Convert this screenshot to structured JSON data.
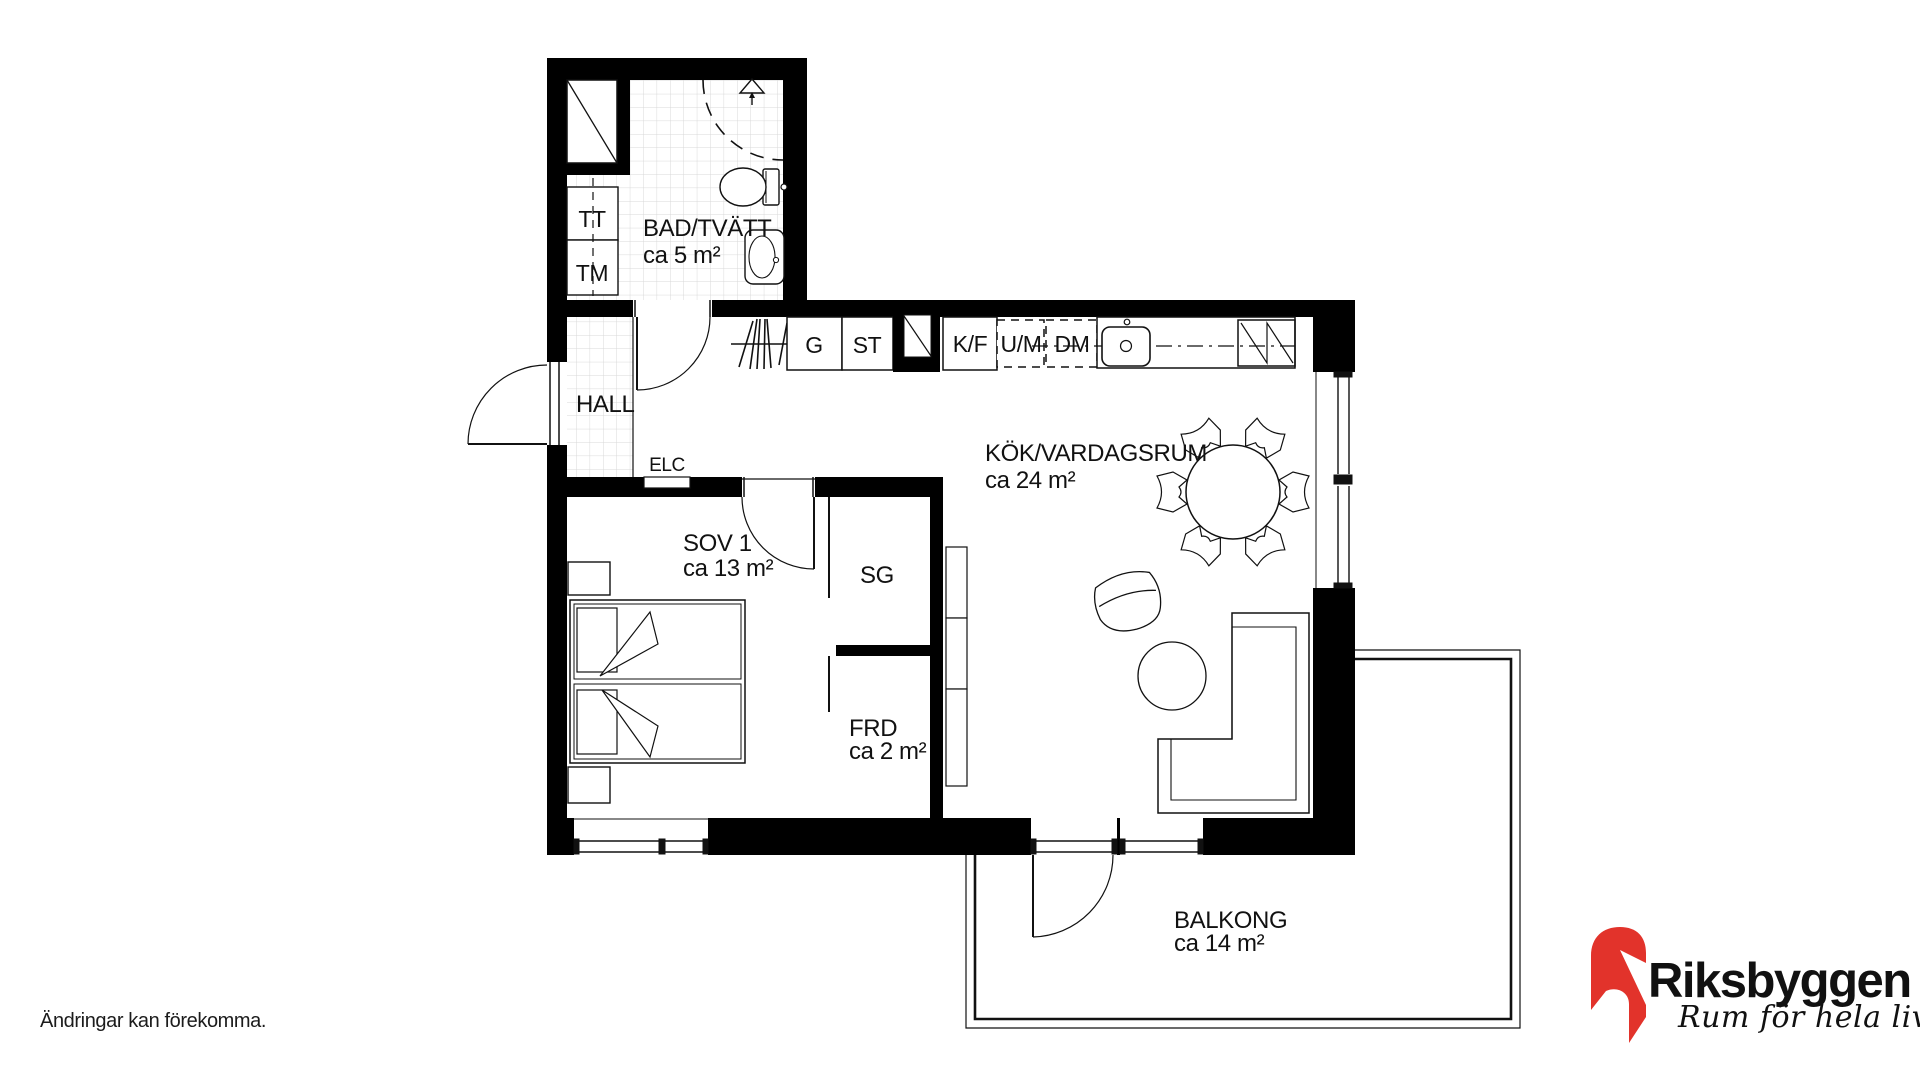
{
  "plan": {
    "rooms": {
      "bathroom": {
        "name": "BAD/TVÄTT",
        "area": "ca 5 m²"
      },
      "hall": {
        "name": "HALL"
      },
      "kitchen_living": {
        "name": "KÖK/VARDAGSRUM",
        "area": "ca 24 m²"
      },
      "bedroom": {
        "name": "SOV 1",
        "area": "ca 13 m²"
      },
      "sliding_wardrobe": {
        "name": "SG"
      },
      "storage": {
        "name": "FRD",
        "area": "ca 2 m²"
      },
      "balcony": {
        "name": "BALKONG",
        "area": "ca 14 m²"
      }
    },
    "fixtures": {
      "tumble_dryer": "TT",
      "washing_machine": "TM",
      "wardrobe": "G",
      "cleaning_cabinet": "ST",
      "fridge_freezer": "K/F",
      "oven_micro": "U/M",
      "dishwasher": "DM",
      "electrical_cabinet": "ELC"
    }
  },
  "footer": {
    "disclaimer": "Ändringar kan förekomma."
  },
  "logo": {
    "brand": "Riksbyggen",
    "tagline": "Rum för hela livet"
  },
  "colors": {
    "wall": "#000000",
    "line": "#111111",
    "tile_grid": "#d9d9d9",
    "logo_red": "#e2332b",
    "logo_gray": "#9d9d9c"
  }
}
